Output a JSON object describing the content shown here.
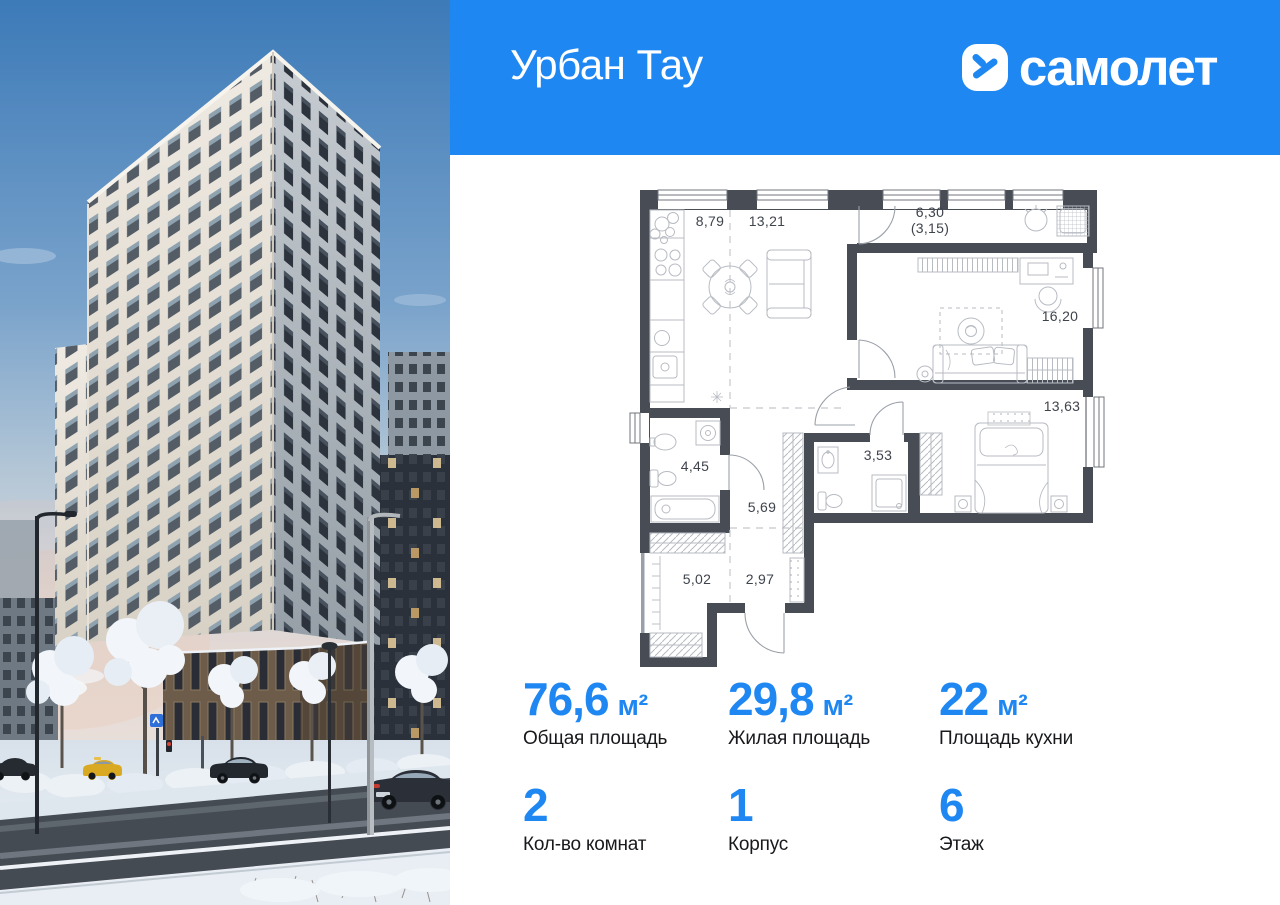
{
  "header": {
    "project_name": "Урбан Тау",
    "brand_wordmark": "самолет",
    "logo_icon": "samolet-arrow-icon"
  },
  "floorplan": {
    "rooms": [
      {
        "id": "kitchen",
        "area": "8,79"
      },
      {
        "id": "living-room",
        "area": "13,21"
      },
      {
        "id": "balcony",
        "area": "6,30",
        "area_secondary": "(3,15)"
      },
      {
        "id": "bedroom-1",
        "area": "16,20"
      },
      {
        "id": "bedroom-2",
        "area": "13,63"
      },
      {
        "id": "bathroom",
        "area": "4,45"
      },
      {
        "id": "hallway",
        "area": "5,69"
      },
      {
        "id": "wc",
        "area": "3,53"
      },
      {
        "id": "storage",
        "area": "5,02"
      },
      {
        "id": "entry-hall",
        "area": "2,97"
      }
    ]
  },
  "stats": {
    "row1": [
      {
        "value": "76,6",
        "unit": "м²",
        "label": "Общая площадь"
      },
      {
        "value": "29,8",
        "unit": "м²",
        "label": "Жилая площадь"
      },
      {
        "value": "22",
        "unit": "м²",
        "label": "Площадь кухни"
      }
    ],
    "row2": [
      {
        "value": "2",
        "label": "Кол-во комнат"
      },
      {
        "value": "1",
        "label": "Корпус"
      },
      {
        "value": "6",
        "label": "Этаж"
      }
    ]
  },
  "theme": {
    "accent": "#1f87f2",
    "header_bg": "#1f87f2",
    "wall": "#484c55",
    "furn": "#b7bbc2",
    "plan_label": "#3f444c",
    "text_dark": "#17191c"
  }
}
